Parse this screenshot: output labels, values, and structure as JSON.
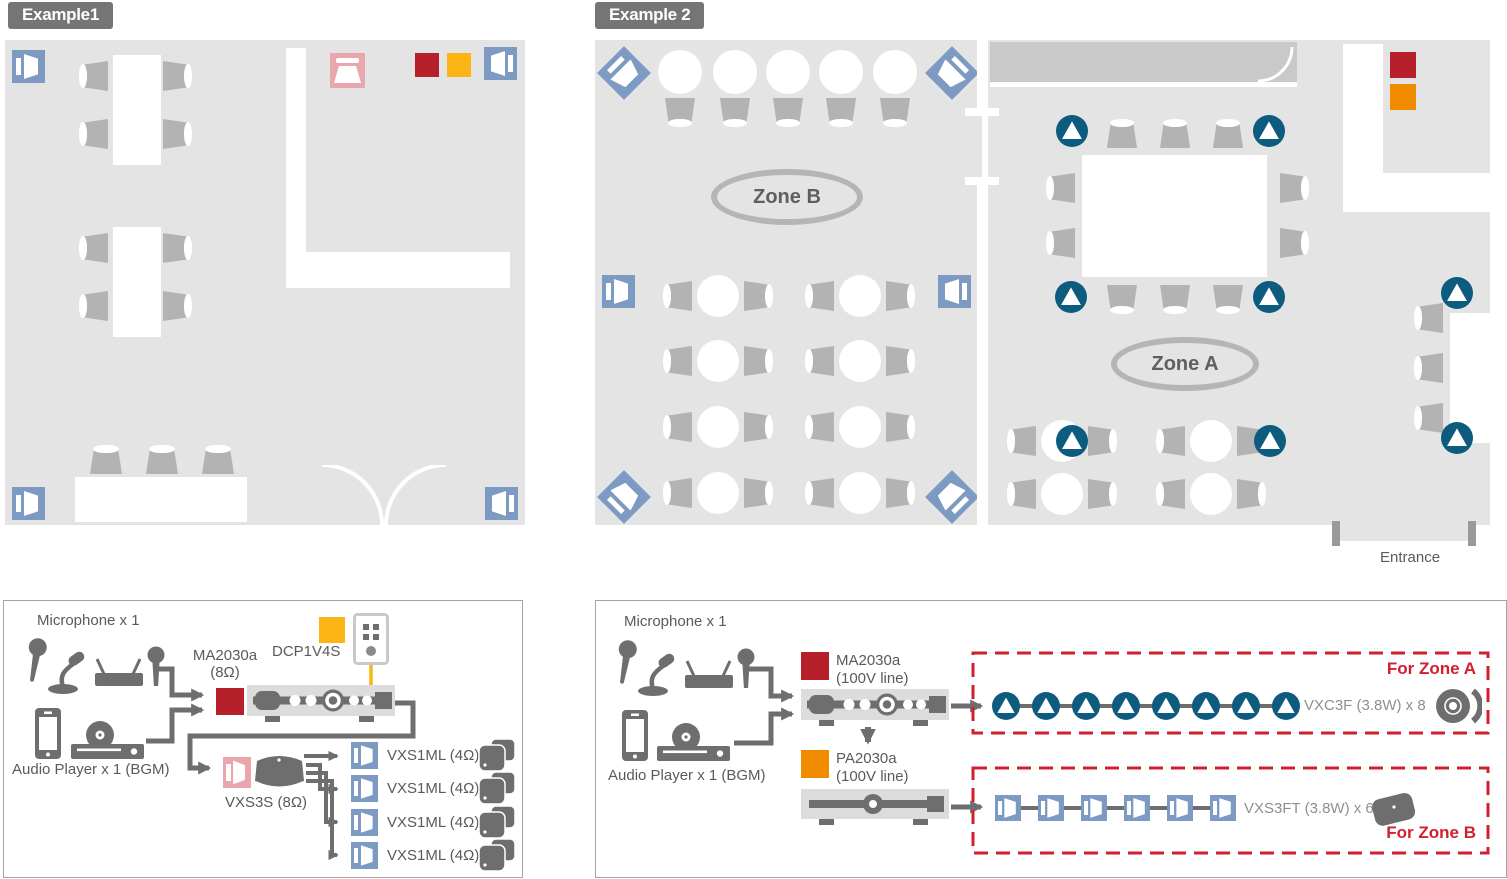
{
  "example1": {
    "badge": "Example1",
    "diagram": {
      "microphone_label": "Microphone x 1",
      "audio_player_label": "Audio Player x 1 (BGM)",
      "amp_model": "MA2030a",
      "amp_spec": "(8Ω)",
      "controller_model": "DCP1V4S",
      "sub_model": "VXS3S (8Ω)",
      "speaker_rows": [
        {
          "label": "VXS1ML (4Ω)"
        },
        {
          "label": "VXS1ML (4Ω)"
        },
        {
          "label": "VXS1ML (4Ω)"
        },
        {
          "label": "VXS1ML (4Ω)"
        }
      ]
    }
  },
  "example2": {
    "badge": "Example 2",
    "floorplan": {
      "zone_b_label": "Zone B",
      "zone_a_label": "Zone A",
      "entrance_label": "Entrance"
    },
    "diagram": {
      "microphone_label": "Microphone x 1",
      "audio_player_label": "Audio Player x 1 (BGM)",
      "amp1_model": "MA2030a",
      "amp1_spec": "(100V line)",
      "amp2_model": "PA2030a",
      "amp2_spec": "(100V line)",
      "zone_a": {
        "tag": "For Zone A",
        "chain_label": "VXC3F (3.8W) x 8",
        "chain_count": 8
      },
      "zone_b": {
        "tag": "For Zone B",
        "chain_label": "VXS3FT (3.8W) x 6",
        "chain_count": 6
      }
    }
  },
  "colors": {
    "floor_gray": "#e4e4e4",
    "counter_gray": "#c9c9c9",
    "speaker_blue": "#7d9ac2",
    "speaker_pink": "#e9a6ad",
    "ceiling_teal": "#0d5c80",
    "ma2030a_red": "#b5202a",
    "pa2030a_orange": "#f18b00",
    "dcp1v4s_yellow": "#fcb515",
    "zone_box_red": "#d11f2f",
    "icon_gray": "#6e6e6e"
  }
}
